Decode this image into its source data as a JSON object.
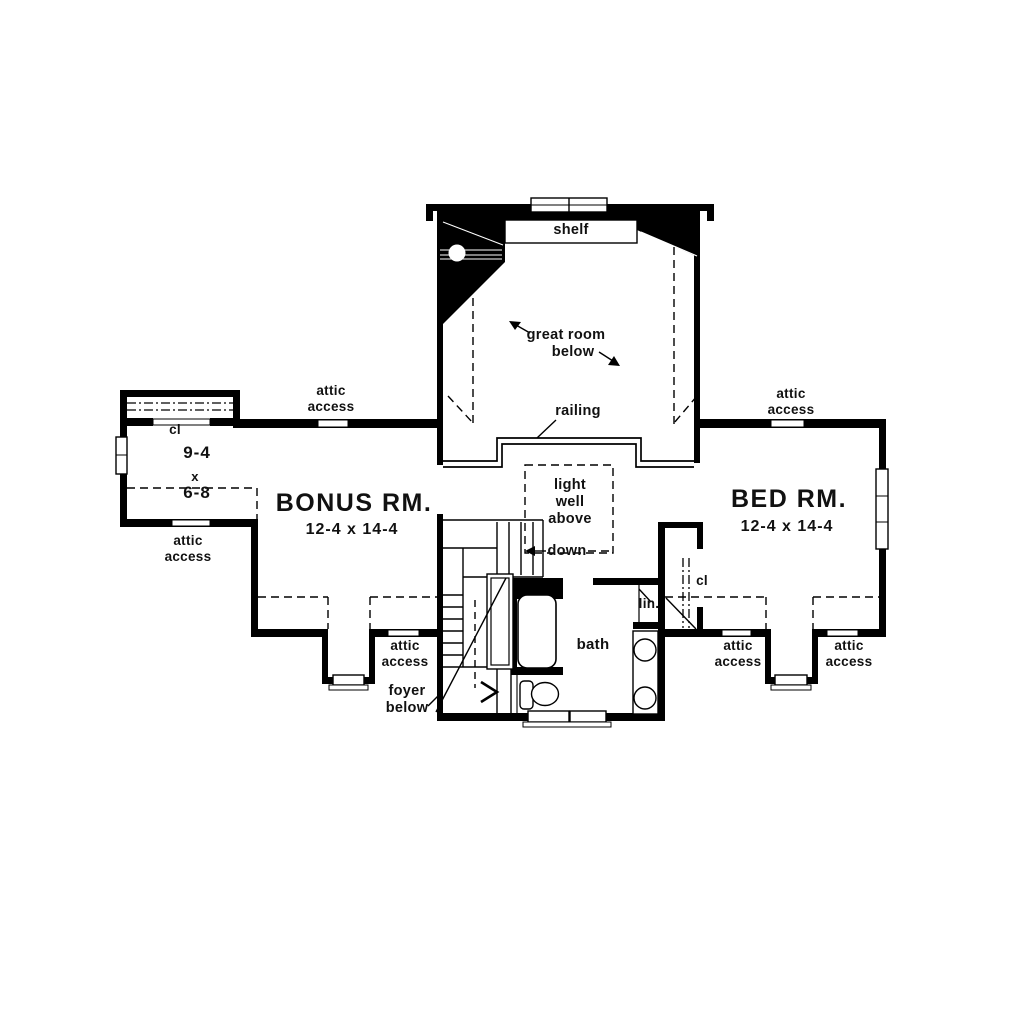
{
  "plan": {
    "type": "second-floor-plan",
    "colors": {
      "wall": "#000000",
      "background": "#ffffff",
      "text": "#111111"
    }
  },
  "labels": {
    "shelf": "shelf",
    "great_room": {
      "line1": "great room",
      "line2": "below"
    },
    "railing": "railing",
    "attic_access": {
      "line1": "attic",
      "line2": "access"
    },
    "closet_left": "cl",
    "closet_left_dims": {
      "width": "9-4",
      "by": "x",
      "depth": "6-8"
    },
    "bonus_room": {
      "name": "BONUS RM.",
      "dims": "12-4 x 14-4"
    },
    "bed_room": {
      "name": "BED RM.",
      "dims": "12-4 x 14-4"
    },
    "light_well": {
      "line1": "light",
      "line2": "well",
      "line3": "above"
    },
    "down": "down",
    "linen": "lin.",
    "closet_right": "cl",
    "bath": "bath",
    "foyer": {
      "line1": "foyer",
      "line2": "below"
    }
  }
}
